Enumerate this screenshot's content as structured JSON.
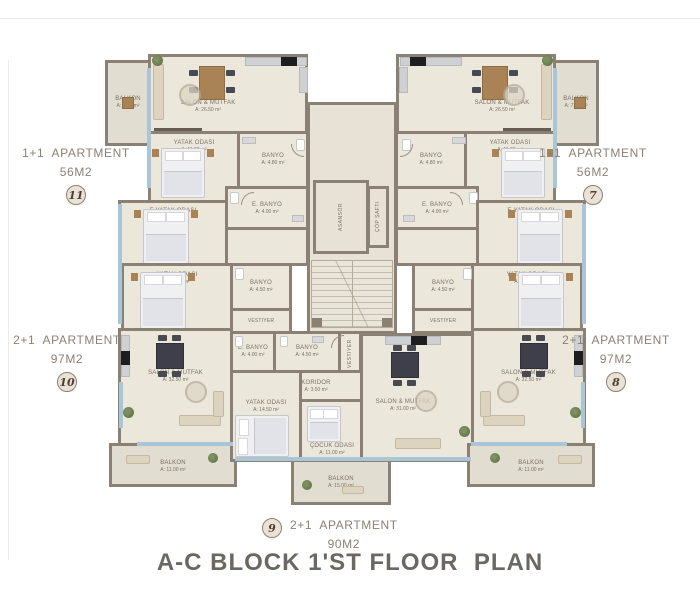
{
  "title": "A-C BLOCK 1'ST FLOOR  PLAN",
  "apartments": {
    "apt11": {
      "type": "1+1  APARTMENT",
      "size": "56M2",
      "number": "11"
    },
    "apt7": {
      "type": "1+1  APARTMENT",
      "size": "56M2",
      "number": "7"
    },
    "apt10": {
      "type": "2+1  APARTMENT",
      "size": "97M2",
      "number": "10"
    },
    "apt8": {
      "type": "2+1  APARTMENT",
      "size": "97M2",
      "number": "8"
    },
    "apt9": {
      "type": "2+1  APARTMENT",
      "size": "90M2",
      "number": "9"
    }
  },
  "rooms": {
    "balkon_7_50": {
      "name": "BALKON",
      "area": "A: 7.50 m²"
    },
    "salon_26_50": {
      "name": "SALON & MUTFAK",
      "area": "A: 26.50 m²"
    },
    "yatak_11_00": {
      "name": "YATAK ODASI",
      "area": "A: 11.00 m²"
    },
    "banyo_4_80": {
      "name": "BANYO",
      "area": "A: 4.80 m²"
    },
    "ebanyo_4_00": {
      "name": "E. BANYO",
      "area": "A: 4.00 m²"
    },
    "eyatak_16_00": {
      "name": "E.YATAK ODASI",
      "area": "A: 16.00 m²"
    },
    "yatak_11_50": {
      "name": "YATAK ODASI",
      "area": "A: 11.50 m²"
    },
    "banyo_4_50": {
      "name": "BANYO",
      "area": "A: 4.50 m²"
    },
    "vestiyer": {
      "name": "VESTIYER"
    },
    "salon_32_50": {
      "name": "SALON & MUTFAK",
      "area": "A: 32.50 m²"
    },
    "balkon_11_00": {
      "name": "BALKON",
      "area": "A: 11.00 m²"
    },
    "koridor_3_50": {
      "name": "KORIDOR",
      "area": "A: 3.50 m²"
    },
    "yatak_14_50": {
      "name": "YATAK ODASI",
      "area": "A: 14.50 m²"
    },
    "cocuk_11_00": {
      "name": "ÇOCUK ODASI",
      "area": "A: 11.00 m²"
    },
    "salon_31_00": {
      "name": "SALON & MUTFAK",
      "area": "A: 31.00 m²"
    },
    "balkon_15_00": {
      "name": "BALKON",
      "area": "A: 15.00 m²"
    },
    "asansor": {
      "name": "ASANSÖR"
    },
    "cop_safti": {
      "name": "ÇÖP ŞAFTI"
    }
  },
  "colors": {
    "wall": "#8a8073",
    "floor": "#ece7db",
    "balcony_floor": "#e2ddd1",
    "core_floor": "#e8e2d6",
    "window": "#a9c6d8",
    "label_text": "#7b7166",
    "caption_text": "#8b8176",
    "title_text": "#6b6762"
  }
}
